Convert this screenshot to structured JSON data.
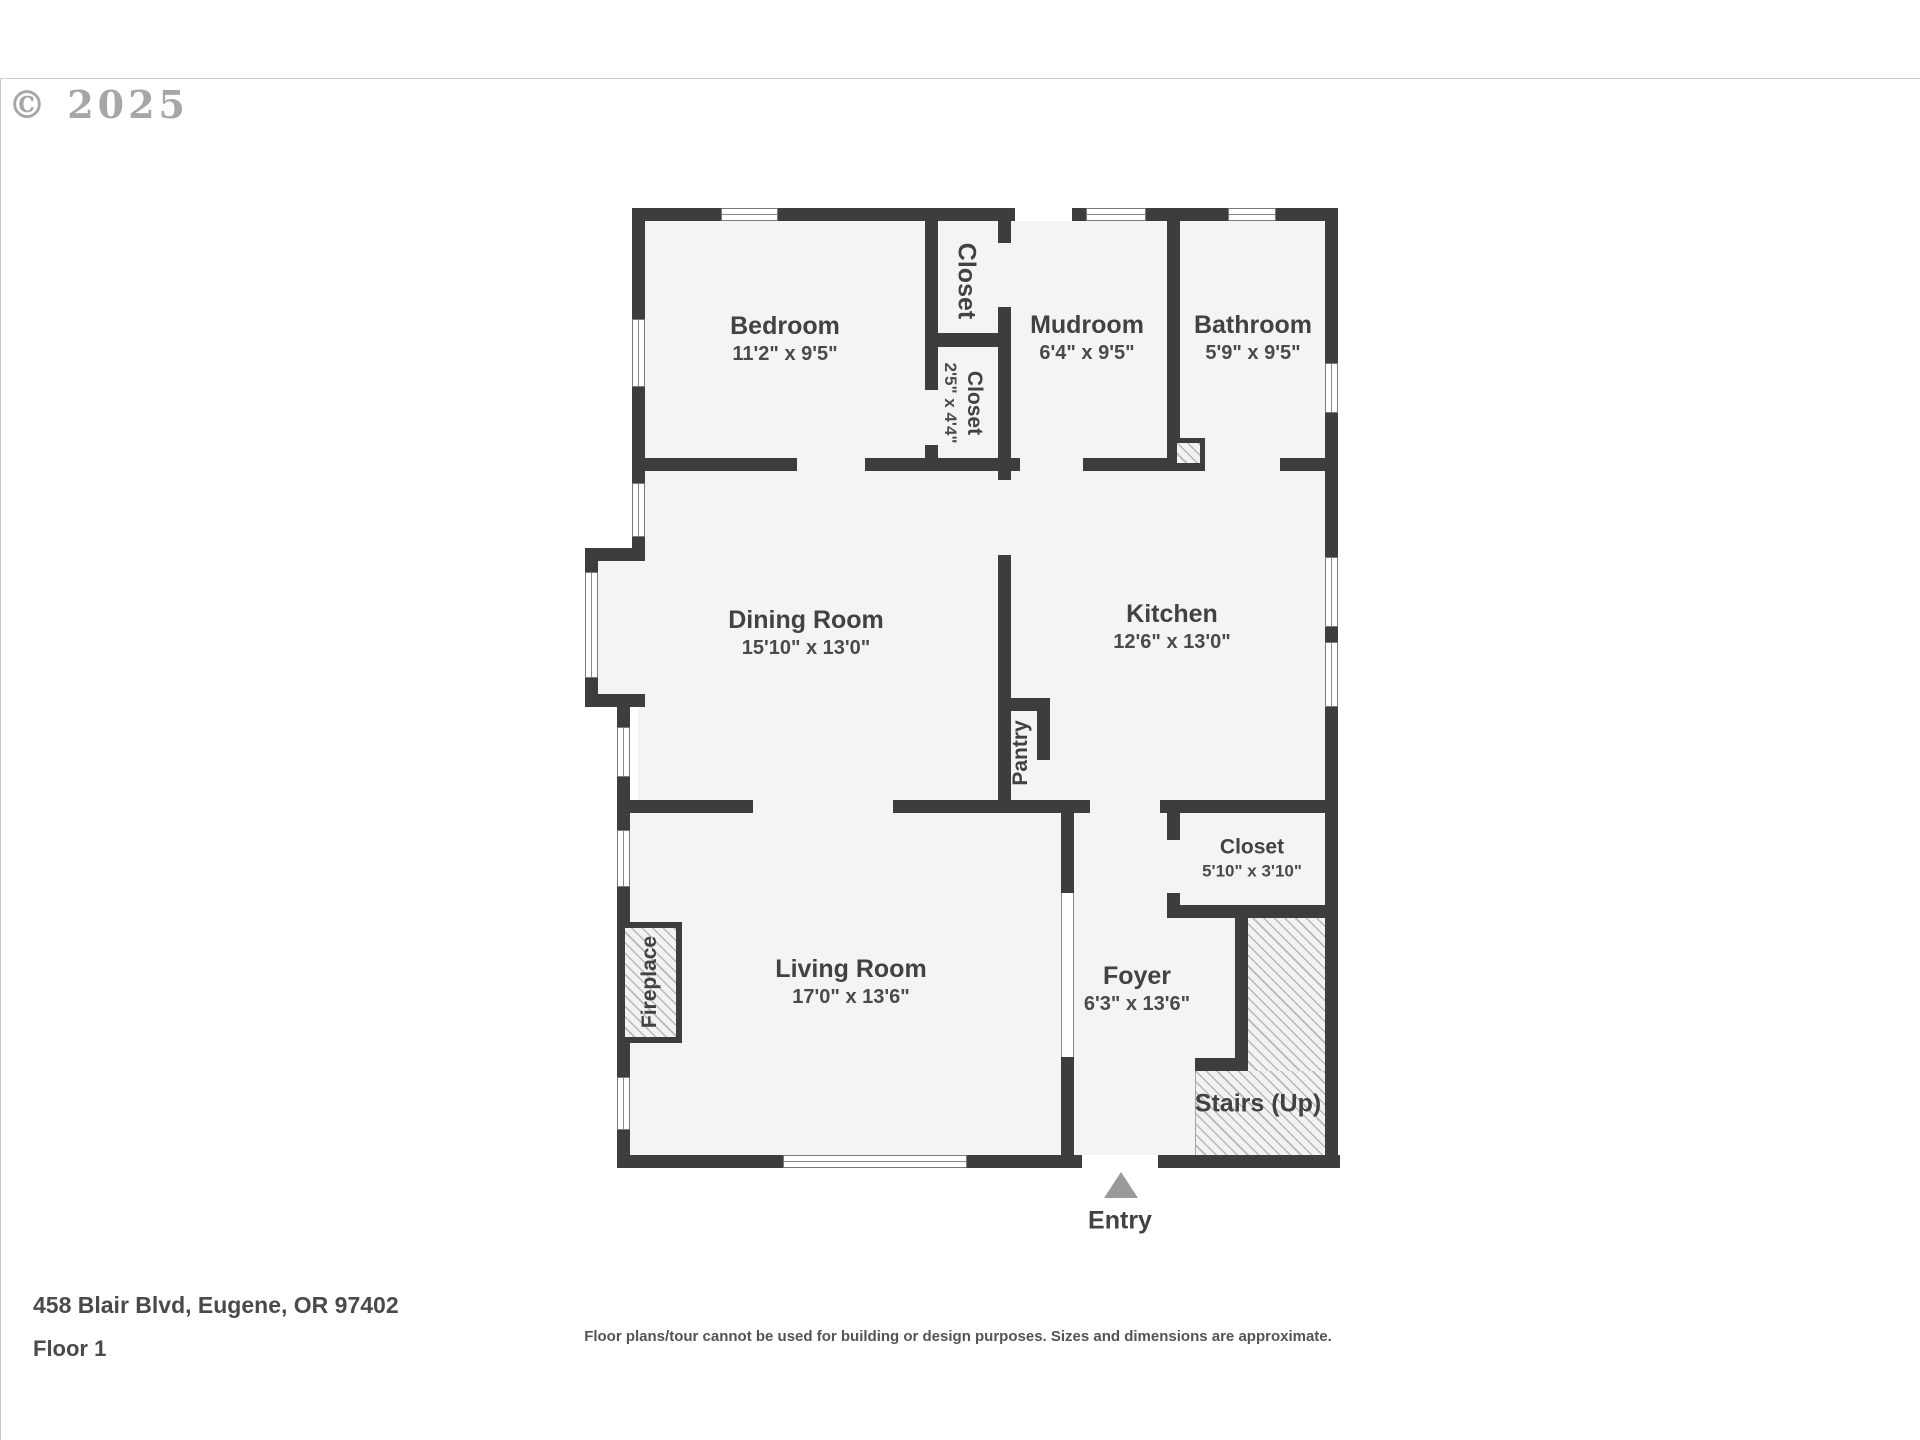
{
  "watermark": {
    "copyright": "© 2025"
  },
  "rooms": [
    {
      "id": "bedroom",
      "name": "Bedroom",
      "dims": "11'2\" x 9'5\""
    },
    {
      "id": "closet-top",
      "name": "Closet",
      "dims": ""
    },
    {
      "id": "mudroom",
      "name": "Mudroom",
      "dims": "6'4\" x 9'5\""
    },
    {
      "id": "bathroom",
      "name": "Bathroom",
      "dims": "5'9\" x 9'5\""
    },
    {
      "id": "closet-mid",
      "name": "Closet",
      "dims": "2'5\" x 4'4\""
    },
    {
      "id": "dining",
      "name": "Dining Room",
      "dims": "15'10\" x 13'0\""
    },
    {
      "id": "kitchen",
      "name": "Kitchen",
      "dims": "12'6\" x 13'0\""
    },
    {
      "id": "pantry",
      "name": "Pantry",
      "dims": ""
    },
    {
      "id": "closet-foyer",
      "name": "Closet",
      "dims": "5'10\" x 3'10\""
    },
    {
      "id": "living",
      "name": "Living Room",
      "dims": "17'0\" x 13'6\""
    },
    {
      "id": "foyer",
      "name": "Foyer",
      "dims": "6'3\" x 13'6\""
    },
    {
      "id": "fireplace",
      "name": "Fireplace",
      "dims": ""
    },
    {
      "id": "stairs",
      "name": "Stairs (Up)",
      "dims": ""
    },
    {
      "id": "entry",
      "name": "Entry",
      "dims": ""
    }
  ],
  "footer": {
    "address": "458 Blair Blvd, Eugene, OR 97402",
    "floor": "Floor 1",
    "disclaimer": "Floor plans/tour cannot be used for building or design purposes. Sizes and dimensions are approximate."
  },
  "colors": {
    "wall": "#3d3d3d",
    "room_fill": "#f4f4f4",
    "hatch_line": "#b7b7b7",
    "label_text": "#424242",
    "entry_arrow": "#9a9a9a"
  }
}
